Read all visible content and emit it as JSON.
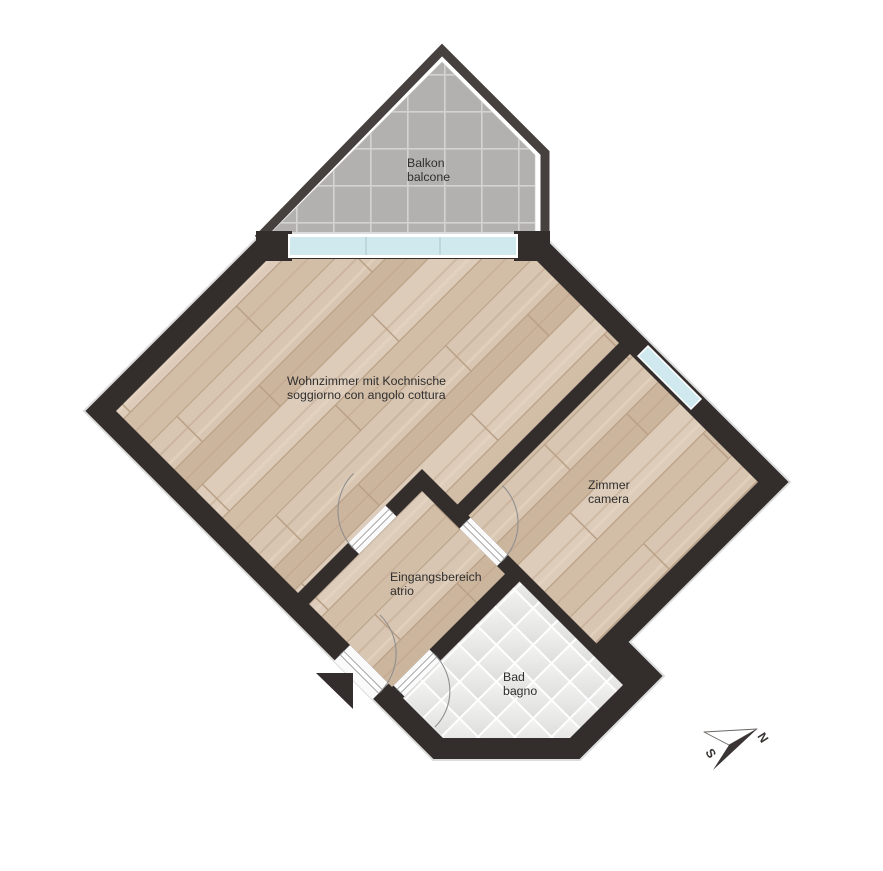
{
  "plan": {
    "type": "apartment-floor-plan",
    "orientation": "rotated-45-degrees"
  },
  "rooms": {
    "balcony": {
      "de": "Balkon",
      "it": "balcone"
    },
    "living": {
      "de": "Wohnzimmer mit Kochnische",
      "it": "soggiorno con angolo cottura"
    },
    "bedroom": {
      "de": "Zimmer",
      "it": "camera"
    },
    "entrance": {
      "de": "Eingangsbereich",
      "it": "atrio"
    },
    "bath": {
      "de": "Bad",
      "it": "bagno"
    }
  },
  "compass": {
    "north": "N",
    "south": "S"
  },
  "colors": {
    "wall": "#332e2c",
    "parapet": "#46403e",
    "glass": "#cfe9ee",
    "glass_frame": "#ffffff",
    "balcony_tile": "#b2b1b0",
    "balcony_grout": "#d4d3d2",
    "bath_tile_light": "#f4f4f3",
    "bath_tile_dark": "#dededd",
    "wood_base": "#d5c2ad",
    "door_leaf": "#ffffff",
    "door_arc": "#8f8f8f",
    "outline": "#dcdcdc",
    "label_text": "#2f2f2f",
    "background": "#ffffff"
  }
}
